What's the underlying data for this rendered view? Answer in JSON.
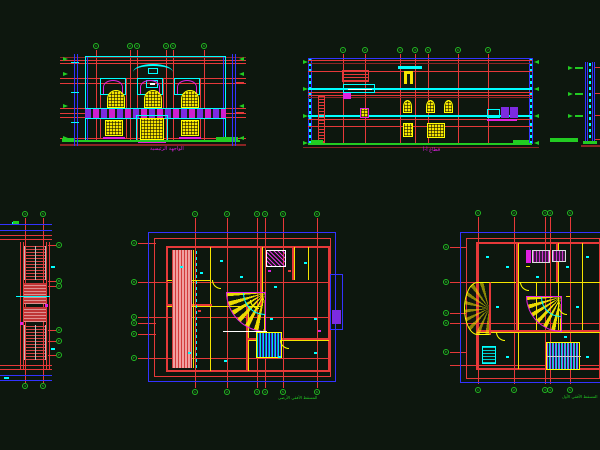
{
  "canvas": {
    "background": "#0d170e"
  },
  "titles": {
    "front_elevation": "الواجهة الرئيسية",
    "section": "قطاع أ-أ",
    "ground_floor_plan": "المسقط الأفقي الأرضي",
    "first_floor_plan": "المسقط الأفقي الأول"
  },
  "grids": {
    "elev_top": [
      "1",
      "2",
      "3",
      "4",
      "5",
      "6"
    ],
    "section_top": [
      "1",
      "2",
      "3",
      "4",
      "5",
      "6",
      "7"
    ],
    "left_plan_top": [
      "4",
      "5"
    ],
    "left_plan_bottom": [
      "4",
      "5"
    ],
    "left_plan_side": [
      "A",
      "B",
      "C",
      "D",
      "E",
      "F"
    ],
    "center_plan_top": [
      "1",
      "2",
      "3",
      "4",
      "5",
      "6"
    ],
    "center_plan_bottom": [
      "1",
      "2",
      "3",
      "4",
      "5",
      "6"
    ],
    "center_plan_side": [
      "A",
      "B",
      "C",
      "D",
      "E",
      "F"
    ],
    "right_plan_top": [
      "1",
      "2",
      "3",
      "4",
      "5"
    ],
    "right_plan_bottom": [
      "1",
      "2",
      "3",
      "4",
      "5"
    ],
    "right_plan_side": [
      "A",
      "B",
      "C",
      "D",
      "E"
    ]
  },
  "colors": {
    "red": "#e63939",
    "dark_red": "#8a2424",
    "cyan": "#00ffff",
    "yellow": "#f5e400",
    "magenta": "#e020e0",
    "green": "#22cc22",
    "blue": "#3333ff",
    "purple": "#7d2be0",
    "pink": "#f0a0a0",
    "white": "#ffffff"
  }
}
